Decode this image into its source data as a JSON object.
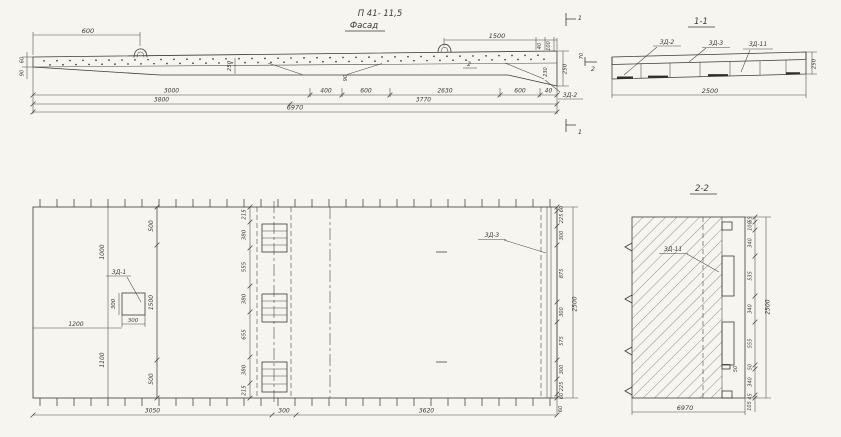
{
  "drawing": {
    "title": "П 41- 11,5",
    "subtitle": "Фасад",
    "colors": {
      "paper": "#f6f5f0",
      "ink": "#3b3b37"
    },
    "facade": {
      "dim_600": "600",
      "dim_1500": "1500",
      "dim_40": "40",
      "dim_100": "100",
      "dim_250_right": "250",
      "dim_230": "230",
      "dim_70": "70",
      "dim_60_left": "60",
      "dim_90_left": "90",
      "dim_250_mid": "250",
      "dim_90_mid": "90",
      "row1": [
        "3000",
        "400",
        "600",
        "2630",
        "600",
        "40"
      ],
      "row2": [
        "3800",
        "3770"
      ],
      "row3": [
        "6970"
      ],
      "label_zd2": "ЗД-2",
      "mark_1": "1",
      "mark_2": "2"
    },
    "section11": {
      "title": "1-1",
      "label_zd2": "ЗД-2",
      "label_zd3": "ЗД-3",
      "label_zd11": "ЗД-11",
      "dim_width": "2500",
      "dim_height": "250"
    },
    "plan": {
      "dim_1000": "1000",
      "dim_1100": "1100",
      "label_zd1": "ЗД-1",
      "dim_300_v": "300",
      "dim_300_h": "300",
      "dim_1200": "1200",
      "label_zd3": "ЗД-3",
      "left_chain": [
        "500",
        "1500",
        "500"
      ],
      "mid_chain": [
        "215",
        "380",
        "555",
        "380",
        "655",
        "380",
        "215"
      ],
      "right_chain": [
        "60",
        "225",
        "300",
        "875",
        "300",
        "575",
        "300",
        "225",
        "60"
      ],
      "bottom_chain": [
        "3050",
        "300",
        "3620"
      ],
      "dim_2500": "2500",
      "dim_60_end": "60"
    },
    "section22": {
      "title": "2-2",
      "label_zd11": "ЗД-11",
      "right_chain": [
        "65",
        "100",
        "340",
        "535",
        "340",
        "555",
        "50",
        "340",
        "45"
      ],
      "dim_50": "50",
      "dim_105": "105",
      "dim_2500": "2500",
      "dim_6970": "6970"
    }
  }
}
